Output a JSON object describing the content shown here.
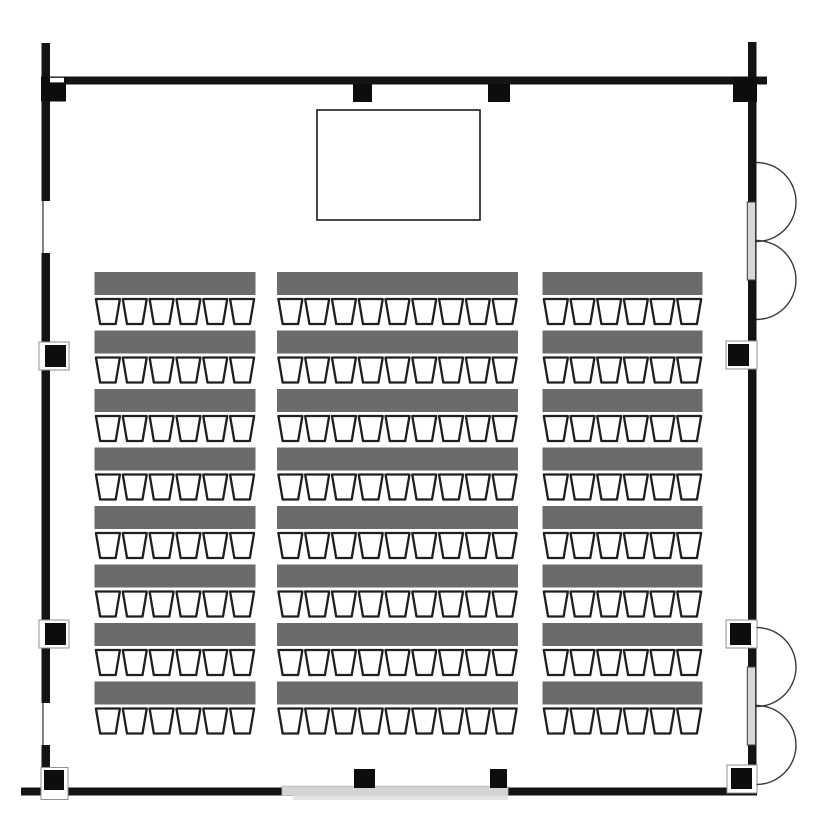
{
  "canvas": {
    "width": 840,
    "height": 840,
    "background": "#ffffff"
  },
  "palette": {
    "wall": "#141414",
    "block": "#0d0d0d",
    "table": "#6b6b6b",
    "chair_fill": "#ffffff",
    "chair_stroke": "#1f1f1f",
    "stage_fill": "#ffffff",
    "stage_stroke": "#1a1a1a",
    "door_slab": "#d8d8d8",
    "door_slab_stroke": "#3a3a3a",
    "arc_stroke": "#3a3a3a",
    "opening_slab": "#d4d4d4",
    "opening_lip": "#e4e4e4",
    "opening_stroke": "#b5b5b5",
    "frame_white": "#ffffff",
    "frame_stroke": "#8f8f8f",
    "window_line": "#4a4a4a"
  },
  "walls": [
    {
      "name": "wall-top",
      "x": 44,
      "y": 76.5,
      "w": 723,
      "h": 8
    },
    {
      "name": "wall-left",
      "x": 41.5,
      "y": 43,
      "w": 8.5,
      "h": 745
    },
    {
      "name": "wall-right",
      "x": 748,
      "y": 42,
      "w": 8.5,
      "h": 750
    },
    {
      "name": "wall-bottom",
      "x": 21,
      "y": 787.5,
      "w": 736,
      "h": 8
    }
  ],
  "solid_blocks": [
    {
      "name": "corner-post-top-left",
      "x": 41,
      "y": 76.5,
      "w": 25,
      "h": 25
    },
    {
      "name": "corner-post-top-right",
      "x": 733,
      "y": 76.5,
      "w": 24,
      "h": 25.5
    },
    {
      "name": "column-top-a",
      "x": 353,
      "y": 84,
      "w": 19,
      "h": 18
    },
    {
      "name": "column-top-b",
      "x": 488,
      "y": 84,
      "w": 22,
      "h": 18
    },
    {
      "name": "column-bottom-a",
      "x": 354,
      "y": 769,
      "w": 21,
      "h": 19
    },
    {
      "name": "column-bottom-b",
      "x": 490,
      "y": 769,
      "w": 17,
      "h": 19
    }
  ],
  "corner_notch": {
    "x": 50,
    "y": 77.8,
    "w": 14,
    "h": 4.6
  },
  "windows": [
    {
      "name": "window-left-upper",
      "x": 41.5,
      "y": 201,
      "w": 8.5,
      "h": 52,
      "line_x": 43
    },
    {
      "name": "window-left-lower",
      "x": 41.5,
      "y": 703,
      "w": 8.5,
      "h": 42,
      "line_x": 43
    }
  ],
  "framed_blocks": [
    {
      "name": "wall-fixture-left-upper",
      "frame": {
        "x": 39,
        "y": 342,
        "w": 30,
        "h": 28
      },
      "core": {
        "x": 45,
        "y": 345,
        "w": 21,
        "h": 22
      }
    },
    {
      "name": "wall-fixture-left-lower",
      "frame": {
        "x": 39,
        "y": 620,
        "w": 30,
        "h": 28
      },
      "core": {
        "x": 45,
        "y": 623,
        "w": 21,
        "h": 22
      }
    },
    {
      "name": "wall-fixture-right-upper",
      "frame": {
        "x": 726,
        "y": 341,
        "w": 31,
        "h": 28
      },
      "core": {
        "x": 728,
        "y": 344,
        "w": 21,
        "h": 22
      }
    },
    {
      "name": "wall-fixture-right-lower",
      "frame": {
        "x": 726,
        "y": 620,
        "w": 31,
        "h": 28
      },
      "core": {
        "x": 730,
        "y": 623,
        "w": 21,
        "h": 22
      }
    },
    {
      "name": "corner-post-bottom-left",
      "frame": {
        "x": 41,
        "y": 767.5,
        "w": 27,
        "h": 32
      },
      "core": {
        "x": 44,
        "y": 770,
        "w": 20,
        "h": 20
      }
    },
    {
      "name": "corner-post-bottom-right",
      "frame": {
        "x": 727,
        "y": 765,
        "w": 30,
        "h": 28
      },
      "core": {
        "x": 731,
        "y": 768,
        "w": 21,
        "h": 21
      }
    }
  ],
  "doors_right_wall": [
    {
      "name": "double-door-right-upper",
      "slab": {
        "x": 747.3,
        "y": 202,
        "w": 8.2,
        "h": 78
      },
      "hinge_x": 756.5,
      "arc_centers_y": [
        202,
        280
      ],
      "radius": 39.5
    },
    {
      "name": "double-door-right-lower",
      "slab": {
        "x": 747.3,
        "y": 667,
        "w": 8.2,
        "h": 78
      },
      "hinge_x": 756.5,
      "arc_centers_y": [
        667,
        745
      ],
      "radius": 39.5
    }
  ],
  "bottom_opening": {
    "name": "sliding-door-bottom",
    "slab": {
      "x": 282,
      "y": 786.2,
      "w": 226,
      "h": 9.4
    },
    "lip": {
      "x": 293,
      "y": 795.4,
      "w": 215,
      "h": 4.6
    }
  },
  "stage": {
    "name": "stage-area",
    "x": 317,
    "y": 110,
    "w": 163,
    "h": 110,
    "stroke_width": 1.6
  },
  "seating": {
    "rows": 8,
    "row_start_y": 272,
    "row_pitch": 58.5,
    "table_height": 23,
    "chair_gap": 4,
    "chair_height": 25,
    "chair_top_width": 24,
    "chair_bottom_width": 15.5,
    "chair_stroke_width": 2.3,
    "columns": [
      {
        "name": "seating-column-left",
        "x": 94.5,
        "w": 161,
        "chairs_per_row": 6
      },
      {
        "name": "seating-column-center",
        "x": 277,
        "w": 241,
        "chairs_per_row": 9
      },
      {
        "name": "seating-column-right",
        "x": 542.5,
        "w": 160,
        "chairs_per_row": 6
      }
    ]
  }
}
